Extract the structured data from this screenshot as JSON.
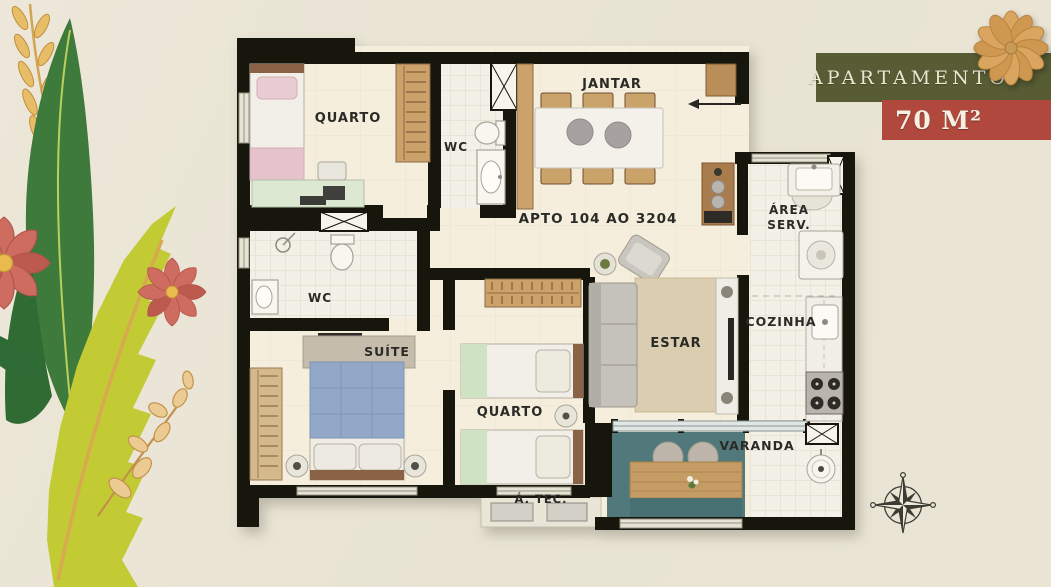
{
  "header": {
    "banner_title": "APARTAMENTO",
    "banner_area": "70 M²"
  },
  "labels": {
    "quarto_top": "QUARTO",
    "wc_top": "WC",
    "jantar": "JANTAR",
    "unit": "APTO 104 AO 3204",
    "area_serv_1": "ÁREA",
    "area_serv_2": "SERV.",
    "wc_suite": "WC",
    "suite": "SUÍTE",
    "quarto_bottom": "QUARTO",
    "estar": "ESTAR",
    "cozinha": "COZINHA",
    "varanda": "VARANDA",
    "area_tec": "Á. TEC."
  },
  "icons": {
    "compass": "compass-rose",
    "top_right_flower": "paper-flower",
    "left_decor": [
      "wheat-sprig",
      "dark-green-leaf",
      "coral-flowers",
      "chartreuse-leaf",
      "golden-branch"
    ]
  },
  "colors": {
    "background": "#e9e4d4",
    "banner_green": "#575c34",
    "banner_red": "#b1483e",
    "wall": "#171411",
    "floor": "#f5eedd",
    "tile": "#f2f0e7",
    "varanda_teal": "#51797b",
    "deck_wood": "#c59c63",
    "suite_bed_blue": "#93a8c7",
    "bed_green": "#cfe2c4",
    "bed_pink": "#e6c3cc",
    "rug": "#dbcdaf",
    "leaf_dark_green": "#3e7a3c",
    "leaf_chartreuse": "#c2ca34",
    "flower_coral": "#ce6c5f",
    "flower_tan": "#d9a55f",
    "label_text": "#2c2a25"
  }
}
